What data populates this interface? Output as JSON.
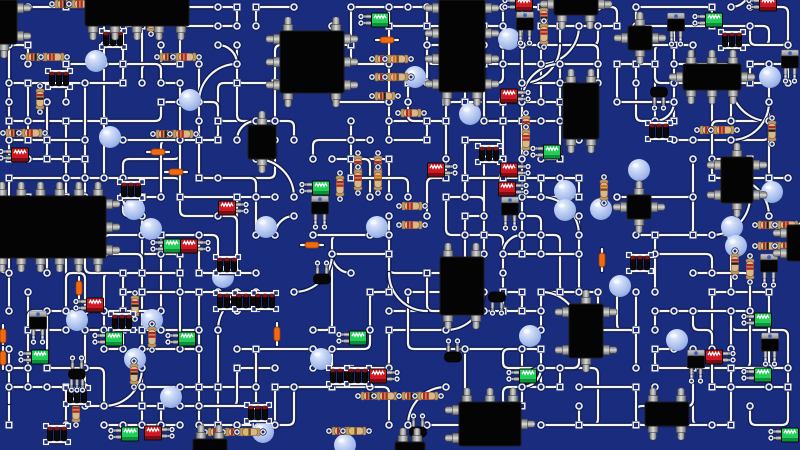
{
  "meta": {
    "label": "printed circuit board illustration"
  },
  "board": {
    "width": 800,
    "height": 450,
    "background": "#1a2c7e",
    "trace": "#f4f3ee",
    "trace_shadow": "#0c1950",
    "trace_width": 2.2,
    "shadow_width": 4.6
  },
  "palette": {
    "ic_body": "#040404",
    "ic_stroke": "#1c1c1c",
    "pin_light": "#d9d9d9",
    "pin_dark": "#6a6a6a",
    "pin_stroke": "#454545",
    "resistor_body": "#d8b88a",
    "resistor_cap": "#c09a62",
    "resistor_stroke": "#8a6a40",
    "res_bands": [
      [
        "#b02a1e",
        "#241812"
      ],
      [
        "#b02a1e",
        "#b02a1e"
      ],
      [
        "#e07020",
        "#7a4a20"
      ],
      [
        "#d8c050",
        "#7a4a20"
      ]
    ],
    "led_red": "#d01822",
    "led_red_dark": "#7d0d14",
    "led_green": "#1fcf58",
    "led_green_dark": "#0e8f3c",
    "led_stroke": "#0a0a0a",
    "zigzag": "#ffffff",
    "fuse": "#f06a10",
    "fuse_stroke": "#a33c00",
    "cap_body": "#0a0a0a",
    "cap_tip": "#801518",
    "tab_dot": "#3d5ec4",
    "ball_hi": "#eef3fe",
    "ball_mid": "#c2d2f4",
    "ball_lo": "#9db5e8",
    "ball_edge": "#7e96cf"
  },
  "mesh": {
    "seed": 73,
    "cell": 19,
    "offset_x": 9,
    "offset_y": 7,
    "paths": 175,
    "max_segments": 5,
    "arcs": 30,
    "square_pad_probability": 0.5
  },
  "spheres": [
    [
      96,
      61
    ],
    [
      110,
      137
    ],
    [
      190,
      100
    ],
    [
      134,
      209
    ],
    [
      151,
      229
    ],
    [
      266,
      227
    ],
    [
      223,
      277
    ],
    [
      509,
      39
    ],
    [
      415,
      77
    ],
    [
      470,
      114
    ],
    [
      639,
      170
    ],
    [
      772,
      192
    ],
    [
      732,
      227
    ],
    [
      736,
      246
    ],
    [
      620,
      286
    ],
    [
      77,
      320
    ],
    [
      152,
      320
    ],
    [
      135,
      359
    ],
    [
      171,
      397
    ],
    [
      321,
      359
    ],
    [
      530,
      336
    ],
    [
      677,
      340
    ],
    [
      770,
      77
    ],
    [
      565,
      191
    ],
    [
      565,
      210
    ],
    [
      601,
      209
    ],
    [
      263,
      432
    ],
    [
      377,
      227
    ],
    [
      345,
      445
    ]
  ],
  "components": {
    "resistors": [
      [
        36,
        57,
        "h",
        0
      ],
      [
        54,
        57,
        "h",
        1
      ],
      [
        170,
        57,
        "h",
        0
      ],
      [
        186,
        57,
        "h",
        1
      ],
      [
        65,
        4,
        "h",
        0
      ],
      [
        82,
        4,
        "h",
        1
      ],
      [
        151,
        21,
        "v",
        0
      ],
      [
        166,
        134,
        "h",
        0
      ],
      [
        183,
        134,
        "h",
        1
      ],
      [
        40,
        99,
        "v",
        0
      ],
      [
        16,
        133,
        "h",
        0
      ],
      [
        32,
        133,
        "h",
        1
      ],
      [
        385,
        59,
        "h",
        0
      ],
      [
        398,
        59,
        "h",
        2
      ],
      [
        385,
        77,
        "h",
        0
      ],
      [
        398,
        77,
        "h",
        2
      ],
      [
        385,
        96,
        "h",
        0
      ],
      [
        411,
        113,
        "h",
        1
      ],
      [
        412,
        206,
        "h",
        1
      ],
      [
        412,
        225,
        "h",
        1
      ],
      [
        768,
        225,
        "h",
        0
      ],
      [
        788,
        225,
        "h",
        1
      ],
      [
        768,
        246,
        "h",
        0
      ],
      [
        788,
        246,
        "h",
        1
      ],
      [
        735,
        264,
        "v",
        0
      ],
      [
        750,
        269,
        "v",
        1
      ],
      [
        604,
        190,
        "v",
        2
      ],
      [
        135,
        306,
        "v",
        0
      ],
      [
        152,
        337,
        "v",
        1
      ],
      [
        134,
        374,
        "v",
        0
      ],
      [
        76,
        412,
        "v",
        1
      ],
      [
        371,
        396,
        "h",
        0
      ],
      [
        387,
        396,
        "h",
        1
      ],
      [
        412,
        396,
        "h",
        0
      ],
      [
        428,
        396,
        "h",
        1
      ],
      [
        342,
        431,
        "h",
        0
      ],
      [
        356,
        431,
        "h",
        3
      ],
      [
        218,
        432,
        "h",
        1
      ],
      [
        236,
        432,
        "h",
        0
      ],
      [
        250,
        432,
        "h",
        3
      ],
      [
        710,
        130,
        "h",
        0
      ],
      [
        724,
        130,
        "h",
        1
      ],
      [
        772,
        131,
        "v",
        0
      ],
      [
        358,
        166,
        "v",
        0
      ],
      [
        358,
        180,
        "v",
        1
      ],
      [
        378,
        166,
        "v",
        0
      ],
      [
        378,
        180,
        "v",
        2
      ],
      [
        340,
        186,
        "v",
        1
      ],
      [
        544,
        18,
        "v",
        0
      ],
      [
        544,
        34,
        "v",
        1
      ],
      [
        526,
        126,
        "v",
        0
      ],
      [
        526,
        140,
        "v",
        1
      ]
    ],
    "fuses": [
      [
        158,
        152,
        "h"
      ],
      [
        176,
        172,
        "h"
      ],
      [
        312,
        245,
        "h"
      ],
      [
        387,
        40,
        "h"
      ],
      [
        277,
        334,
        "v"
      ],
      [
        602,
        260,
        "v"
      ],
      [
        79,
        288,
        "v"
      ],
      [
        3,
        336,
        "v"
      ],
      [
        3,
        358,
        "v"
      ]
    ],
    "capacitor_banks": [
      [
        59,
        79
      ],
      [
        131,
        190
      ],
      [
        489,
        154
      ],
      [
        227,
        265
      ],
      [
        227,
        301
      ],
      [
        246,
        301
      ],
      [
        265,
        301
      ],
      [
        640,
        263
      ],
      [
        732,
        40
      ],
      [
        659,
        131
      ],
      [
        340,
        376
      ],
      [
        358,
        376
      ],
      [
        77,
        396
      ],
      [
        57,
        434
      ],
      [
        258,
        413
      ],
      [
        122,
        322
      ],
      [
        113,
        39
      ]
    ],
    "leds": [
      [
        227,
        208,
        "r",
        "r"
      ],
      [
        189,
        246,
        "r",
        "r"
      ],
      [
        172,
        246,
        "g",
        "l"
      ],
      [
        509,
        96,
        "r",
        "r"
      ],
      [
        436,
        170,
        "r",
        "r"
      ],
      [
        509,
        170,
        "r",
        "r"
      ],
      [
        507,
        189,
        "r",
        "r"
      ],
      [
        378,
        376,
        "r",
        "r"
      ],
      [
        714,
        357,
        "r",
        "r"
      ],
      [
        768,
        4,
        "r",
        "l"
      ],
      [
        524,
        4,
        "r",
        "l"
      ],
      [
        20,
        155,
        "r",
        "l"
      ],
      [
        95,
        305,
        "r",
        "l"
      ],
      [
        153,
        433,
        "r",
        "r"
      ],
      [
        714,
        20,
        "g",
        "l"
      ],
      [
        40,
        357,
        "g",
        "l"
      ],
      [
        114,
        339,
        "g",
        "l"
      ],
      [
        187,
        339,
        "g",
        "l"
      ],
      [
        552,
        152,
        "g",
        "l"
      ],
      [
        763,
        320,
        "g",
        "l"
      ],
      [
        763,
        375,
        "g",
        "l"
      ],
      [
        790,
        435,
        "g",
        "l"
      ],
      [
        528,
        376,
        "g",
        "l"
      ],
      [
        380,
        20,
        "g",
        "l"
      ],
      [
        321,
        188,
        "g",
        "l"
      ],
      [
        130,
        434,
        "g",
        "l"
      ],
      [
        358,
        338,
        "g",
        "l"
      ]
    ],
    "diodes": [
      [
        453,
        357,
        2,
        0
      ],
      [
        418,
        432,
        2,
        0
      ],
      [
        322,
        279,
        2,
        0
      ],
      [
        659,
        92,
        0,
        2
      ],
      [
        77,
        374,
        2,
        3
      ],
      [
        497,
        297,
        0,
        2
      ]
    ],
    "transistors": [
      [
        38,
        322
      ],
      [
        525,
        23
      ],
      [
        676,
        24
      ],
      [
        790,
        61
      ],
      [
        696,
        361
      ],
      [
        770,
        344
      ],
      [
        510,
        208
      ],
      [
        320,
        207
      ],
      [
        769,
        265
      ]
    ],
    "squares": [
      [
        640,
        38
      ],
      [
        639,
        207
      ]
    ],
    "dips": [
      [
        137,
        4,
        104,
        44,
        0,
        0,
        5,
        0
      ],
      [
        312,
        62,
        64,
        62,
        2,
        3,
        2,
        3
      ],
      [
        462,
        46,
        46,
        92,
        0,
        4,
        2,
        4
      ],
      [
        581,
        111,
        36,
        56,
        2,
        0,
        2,
        0
      ],
      [
        50,
        227,
        112,
        62,
        6,
        3,
        6,
        0
      ],
      [
        262,
        142,
        28,
        34,
        1,
        0,
        1,
        0
      ],
      [
        462,
        286,
        44,
        58,
        2,
        0,
        2,
        0
      ],
      [
        712,
        77,
        58,
        26,
        3,
        1,
        3,
        1
      ],
      [
        737,
        180,
        32,
        46,
        1,
        2,
        1,
        2
      ],
      [
        586,
        331,
        34,
        54,
        1,
        2,
        1,
        2
      ],
      [
        667,
        414,
        44,
        24,
        2,
        0,
        2,
        0
      ],
      [
        490,
        424,
        62,
        44,
        3,
        1,
        0,
        2
      ],
      [
        576,
        4,
        44,
        22,
        0,
        1,
        2,
        1
      ],
      [
        4,
        22,
        26,
        44,
        1,
        2,
        1,
        0
      ],
      [
        797,
        243,
        20,
        36,
        0,
        0,
        0,
        2
      ],
      [
        210,
        447,
        34,
        16,
        2,
        0,
        0,
        0
      ],
      [
        410,
        449,
        30,
        14,
        2,
        0,
        0,
        0
      ]
    ]
  }
}
